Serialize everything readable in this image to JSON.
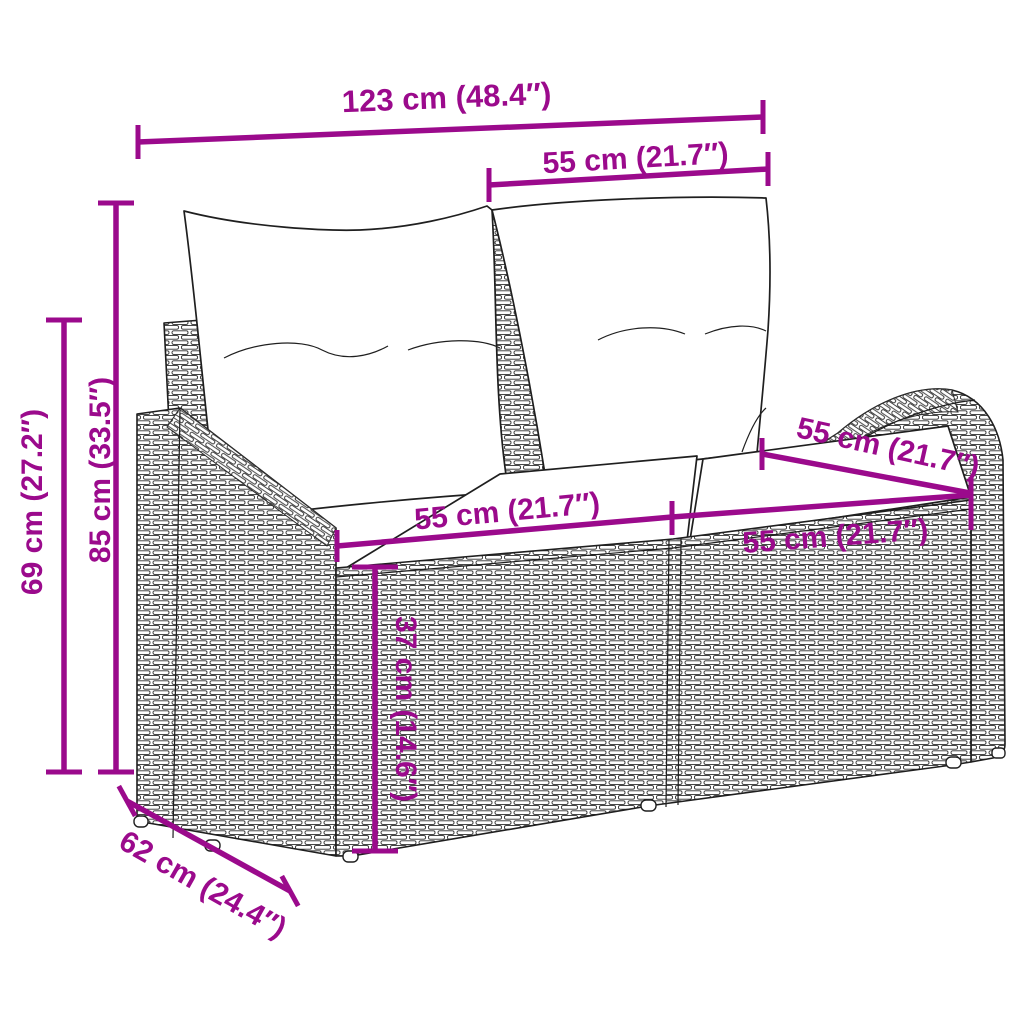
{
  "page": {
    "background": "#ffffff",
    "accent_color": "#9b0a8c",
    "line_color": "#1f1f1f"
  },
  "illustration": {
    "subject": "poly-rattan two-seater garden sofa with back and seat cushions",
    "style": "black line art with woven rattan texture"
  },
  "dims": [
    {
      "id": "total-width",
      "text": "123 cm (48.4″)"
    },
    {
      "id": "backrest-width",
      "text": "55 cm (21.7″)"
    },
    {
      "id": "total-height",
      "text": "85 cm (33.5″)"
    },
    {
      "id": "arm-height",
      "text": "69 cm (27.2″)"
    },
    {
      "id": "seat-left-width",
      "text": "55 cm (21.7″)"
    },
    {
      "id": "seat-depth",
      "text": "55 cm (21.7″)"
    },
    {
      "id": "seat-right-width",
      "text": "55 cm (21.7″)"
    },
    {
      "id": "seat-height",
      "text": "37 cm (14.6″)"
    },
    {
      "id": "base-depth",
      "text": "62 cm (24.4″)"
    }
  ]
}
